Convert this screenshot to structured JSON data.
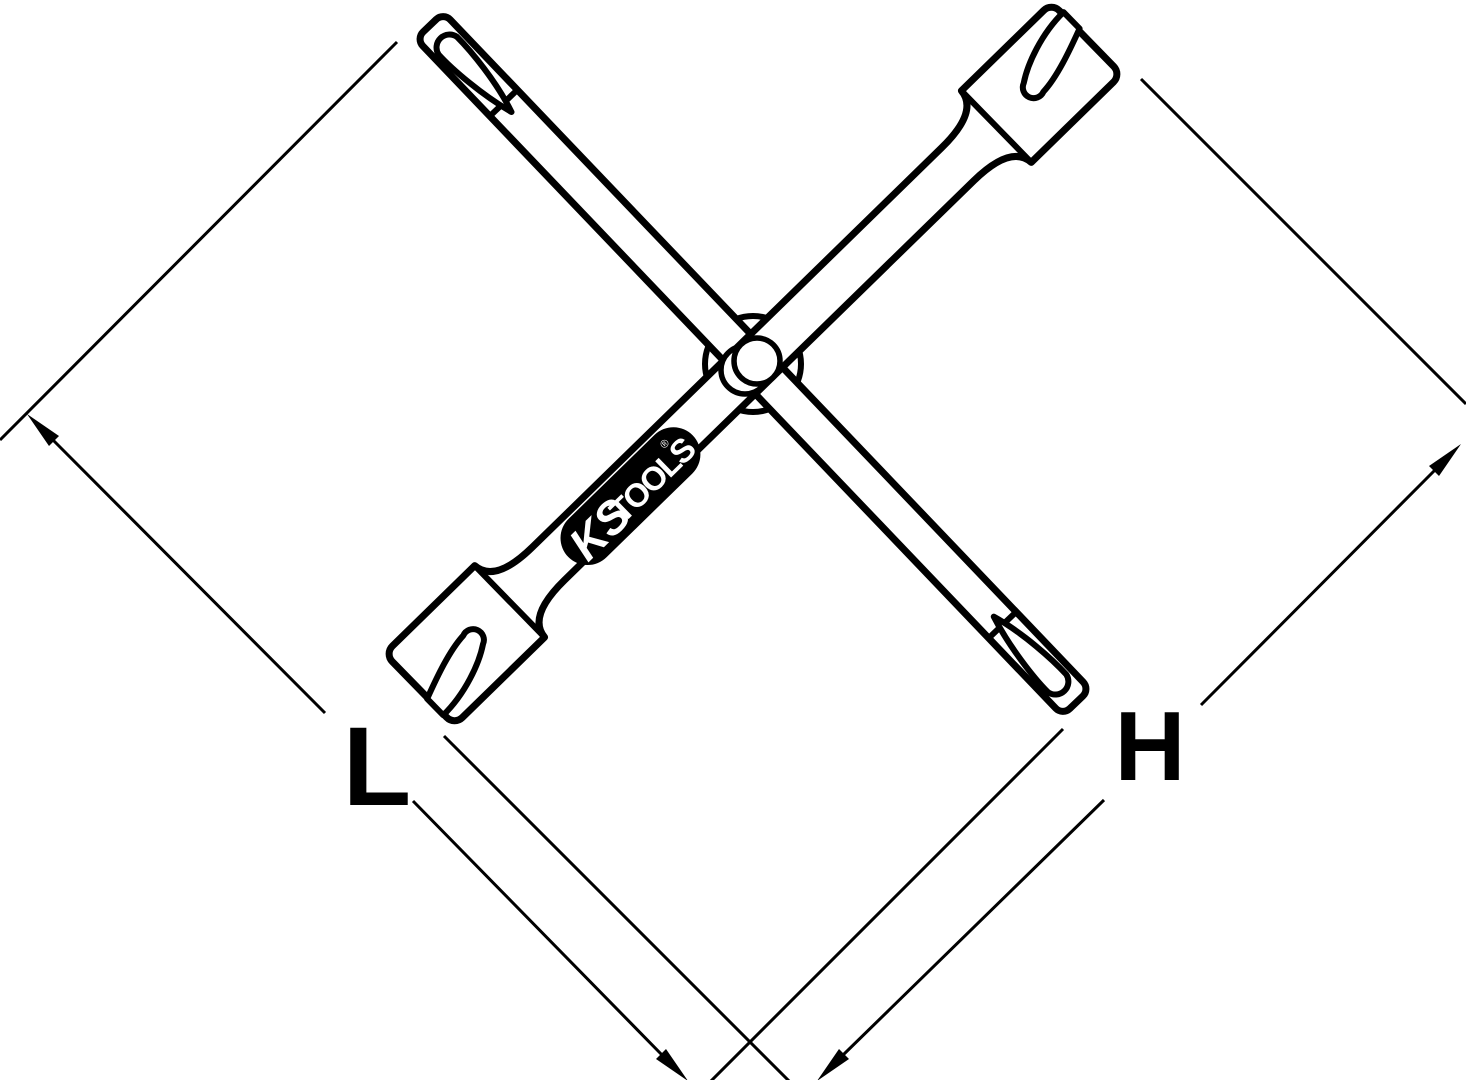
{
  "canvas": {
    "width": 1466,
    "height": 1080,
    "background": "#ffffff",
    "line_color": "#000000"
  },
  "drawing": {
    "subject": "cross wrench technical line drawing",
    "labels": {
      "dimension_l": "L",
      "dimension_h": "H"
    },
    "logo": {
      "ks": "KS",
      "tools": "TOOLS",
      "registered": "®",
      "capsule_color": "#000000",
      "text_color": "#ffffff"
    }
  }
}
